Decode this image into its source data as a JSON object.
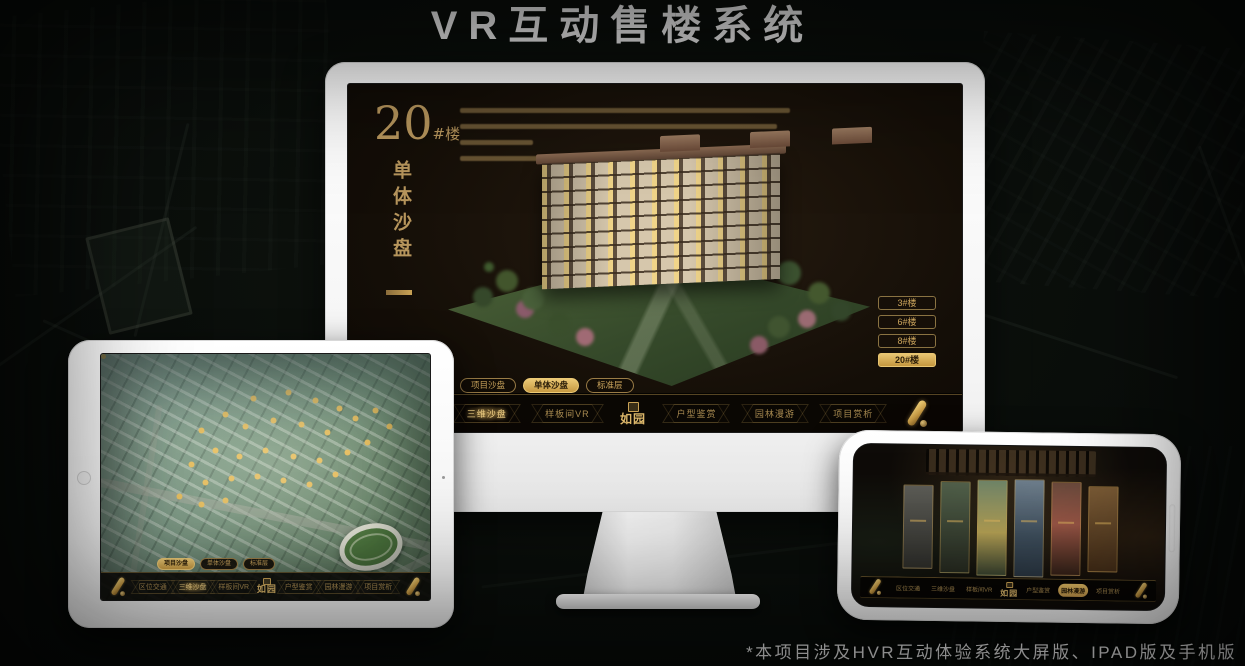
{
  "page": {
    "title": "VR互动售楼系统",
    "footnote": "*本项目涉及HVR互动体验系统大屏版、IPAD版及手机版"
  },
  "colors": {
    "gold": "#c9a255",
    "gold_bright": "#e3bc66",
    "gold_dim": "#8a7342",
    "screen_bg": "#171009"
  },
  "monitor": {
    "heading": {
      "number": "20",
      "suffix": "#楼",
      "subtitle": "单体沙盘"
    },
    "floor_buttons": [
      {
        "label": "3#楼",
        "active": false
      },
      {
        "label": "6#楼",
        "active": false
      },
      {
        "label": "8#楼",
        "active": false
      },
      {
        "label": "20#楼",
        "active": true
      }
    ],
    "tabs": [
      {
        "label": "项目沙盘",
        "active": false
      },
      {
        "label": "单体沙盘",
        "active": true
      },
      {
        "label": "标准层",
        "active": false
      }
    ],
    "nav": {
      "logo": "如园",
      "items": [
        {
          "label": "区位交通",
          "active": false
        },
        {
          "label": "三维沙盘",
          "active": true
        },
        {
          "label": "样板间VR",
          "active": false
        },
        {
          "label": "户型鉴赏",
          "active": false
        },
        {
          "label": "园林漫游",
          "active": false
        },
        {
          "label": "项目赏析",
          "active": false
        }
      ]
    }
  },
  "tablet": {
    "tabs": [
      {
        "label": "项目沙盘",
        "active": true
      },
      {
        "label": "单体沙盘",
        "active": false
      },
      {
        "label": "标准层",
        "active": false
      }
    ],
    "nav": {
      "logo": "如园",
      "items": [
        {
          "label": "区位交通",
          "active": false
        },
        {
          "label": "三维沙盘",
          "active": true
        },
        {
          "label": "样板间VR",
          "active": false
        },
        {
          "label": "户型鉴赏",
          "active": false
        },
        {
          "label": "园林漫游",
          "active": false
        },
        {
          "label": "项目赏析",
          "active": false
        }
      ]
    }
  },
  "phone": {
    "nav": {
      "logo": "如园",
      "items": [
        {
          "label": "区位交通",
          "active": false
        },
        {
          "label": "三维沙盘",
          "active": false
        },
        {
          "label": "样板间VR",
          "active": false
        },
        {
          "label": "户型鉴赏",
          "active": false
        },
        {
          "label": "园林漫游",
          "active": true
        },
        {
          "label": "项目赏析",
          "active": false
        }
      ]
    }
  }
}
